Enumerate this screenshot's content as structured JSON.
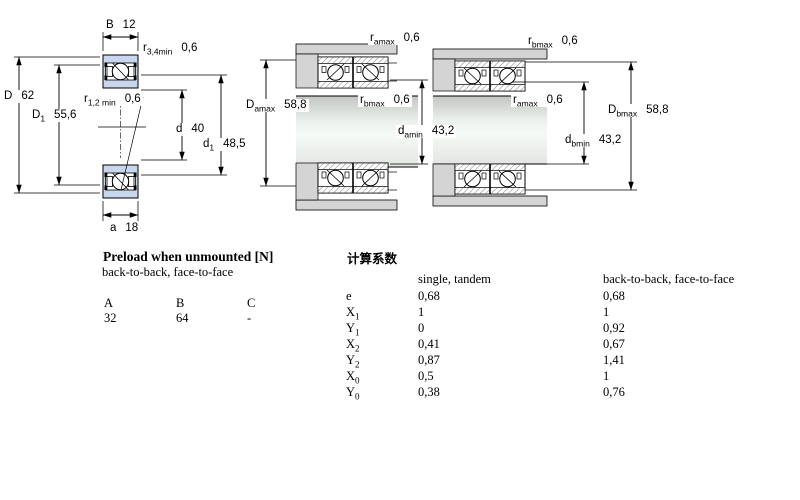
{
  "drawings": {
    "single": {
      "dims": {
        "B": {
          "pre": "B",
          "val": "12"
        },
        "r34": {
          "pre": "r",
          "sub": "3,4min",
          "val": "0,6"
        },
        "D": {
          "pre": "D",
          "val": "62"
        },
        "D1": {
          "pre": "D",
          "sub": "1",
          "val": "55,6"
        },
        "r12": {
          "pre": "r",
          "sub": "1,2 min",
          "val": "0,6"
        },
        "d": {
          "pre": "d",
          "val": "40"
        },
        "d1": {
          "pre": "d",
          "sub": "1",
          "val": "48,5"
        },
        "a": {
          "pre": "a",
          "val": "18"
        }
      }
    },
    "mounted_a": {
      "dims": {
        "ramax": {
          "pre": "r",
          "sub": "amax",
          "val": "0,6"
        },
        "Damax": {
          "pre": "D",
          "sub": "amax",
          "val": "58,8"
        },
        "rbmax": {
          "pre": "r",
          "sub": "bmax",
          "val": "0,6"
        },
        "damin": {
          "pre": "d",
          "sub": "amin",
          "val": "43,2"
        }
      }
    },
    "mounted_b": {
      "dims": {
        "rbmax": {
          "pre": "r",
          "sub": "bmax",
          "val": "0,6"
        },
        "ramax": {
          "pre": "r",
          "sub": "amax",
          "val": "0,6"
        },
        "Dbmax": {
          "pre": "D",
          "sub": "bmax",
          "val": "58,8"
        },
        "dbmin": {
          "pre": "d",
          "sub": "bmin",
          "val": "43,2"
        }
      }
    }
  },
  "preload_table": {
    "title": "Preload when unmounted [N]",
    "subtitle": "back-to-back, face-to-face",
    "columns": [
      "A",
      "B",
      "C"
    ],
    "values": [
      "32",
      "64",
      "-"
    ]
  },
  "factors_table": {
    "title": "计算系数",
    "col1_header": "single, tandem",
    "col2_header": "back-to-back, face-to-face",
    "rows": [
      {
        "sym": "e",
        "sub": "",
        "single": "0,68",
        "paired": "0,68"
      },
      {
        "sym": "X",
        "sub": "1",
        "single": "1",
        "paired": "1"
      },
      {
        "sym": "Y",
        "sub": "1",
        "single": "0",
        "paired": "0,92"
      },
      {
        "sym": "X",
        "sub": "2",
        "single": "0,41",
        "paired": "0,67"
      },
      {
        "sym": "Y",
        "sub": "2",
        "single": "0,87",
        "paired": "1,41"
      },
      {
        "sym": "X",
        "sub": "0",
        "single": "0,5",
        "paired": "1"
      },
      {
        "sym": "Y",
        "sub": "0",
        "single": "0,38",
        "paired": "0,76"
      }
    ]
  },
  "colors": {
    "bearing_blue": "#c8d6ee",
    "housing_gray": "#d4d4d4",
    "line": "#000000"
  }
}
